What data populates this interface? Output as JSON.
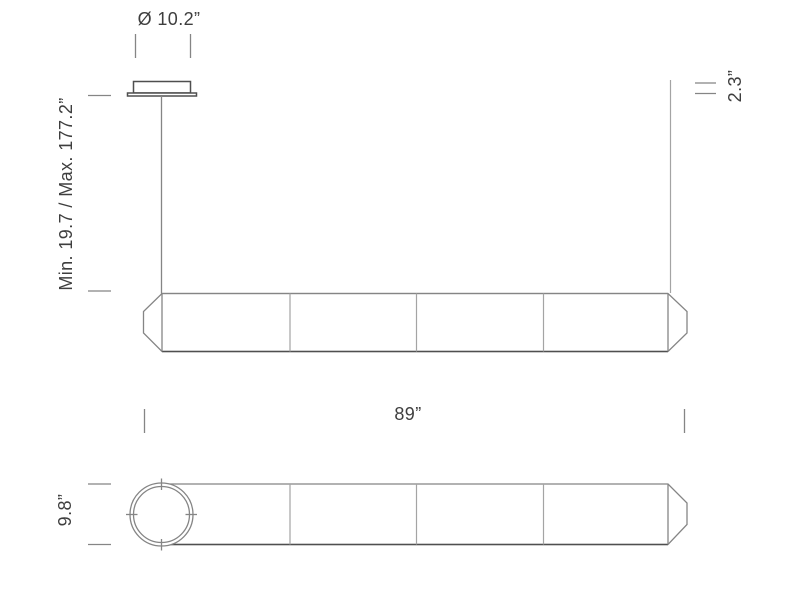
{
  "drawing": {
    "type": "product-dimension-diagram",
    "subject": "linear pendant lamp with canopy, suspension cable, four-segment faceted body (side view) and tubular end view",
    "views": {
      "top": "side elevation with canopy and suspension cable",
      "bottom": "front/end elevation with circular profile"
    },
    "colors": {
      "background": "#ffffff",
      "line": "#858585",
      "line_dark": "#4f4f4f",
      "line_light": "#a4a4a4",
      "text": "#3e3e3e"
    }
  },
  "dimensions": {
    "canopy_diameter": "Ø 10.2”",
    "suspension_range": "Min. 19.7 / Max. 177.2”",
    "canopy_height": "2.3”",
    "fixture_length": "89”",
    "fixture_height": "9.8”"
  }
}
